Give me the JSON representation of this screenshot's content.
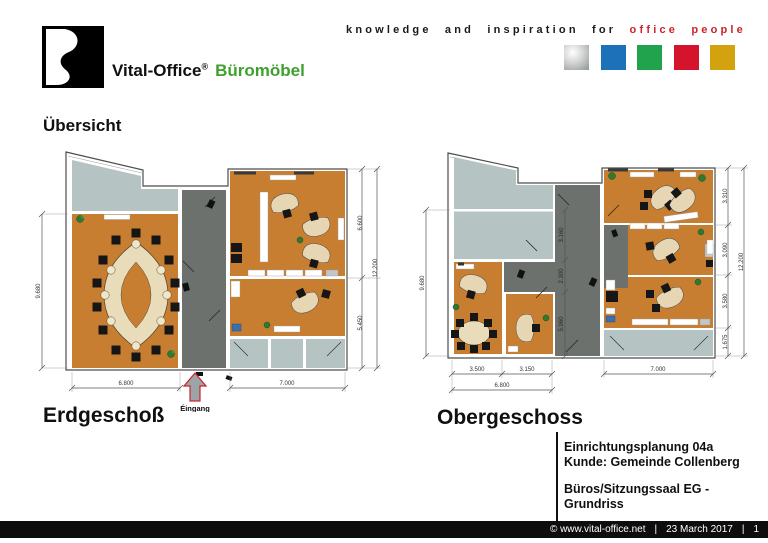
{
  "header": {
    "brand_name": "Vital-Office",
    "brand_reg": "®",
    "brand_suffix": "Büromöbel",
    "tagline_black": "knowledge and inspiration for",
    "tagline_red": "office people",
    "color_squares": [
      "silver",
      "blue",
      "green",
      "red",
      "gold"
    ]
  },
  "overview_title": "Übersicht",
  "erdgeschoss": {
    "label": "Erdgeschoß",
    "entrance": "Éingang",
    "dim_left": "9.680",
    "dim_bottom_left": "6.800",
    "dim_bottom_right": "7.000",
    "dim_right_top": "6.600",
    "dim_right_bottom": "5.450",
    "dim_right_total": "12.200"
  },
  "obergeschoss": {
    "label": "Obergeschoss",
    "dim_left": "9.680",
    "dim_bottom_1": "3.500",
    "dim_bottom_2": "3.150",
    "dim_bottom_total": "6.800",
    "dim_bottom_right": "7.000",
    "dim_mid_1": "3.160",
    "dim_mid_2": "2.300",
    "dim_mid_3": "5.960",
    "dim_right_1": "3.310",
    "dim_right_2": "3.090",
    "dim_right_3": "3.580",
    "dim_right_4": "1.675",
    "dim_right_total": "12.200"
  },
  "info_block": {
    "line1": "Einrichtungsplanung 04a",
    "line2": "Kunde: Gemeinde Collenberg",
    "line3": "Büros/Sitzungssaal EG - Grundriss"
  },
  "footer": {
    "copyright": "© www.vital-office.net",
    "sep1": "|",
    "date": "23 March 2017",
    "sep2": "|",
    "page": "1"
  },
  "colors": {
    "brand_green": "#3FA02E",
    "tagline_red": "#C9252B",
    "floor_orange": "#C87E31",
    "corridor_gray": "#6D716D",
    "zone_gray": "#B5C4C2",
    "square_silver": "#B9BDC1",
    "square_blue": "#1D71B8",
    "square_green": "#21A24C",
    "square_red": "#D3142C",
    "square_gold": "#D2A30F",
    "footer_bg": "#0D0D0D"
  }
}
